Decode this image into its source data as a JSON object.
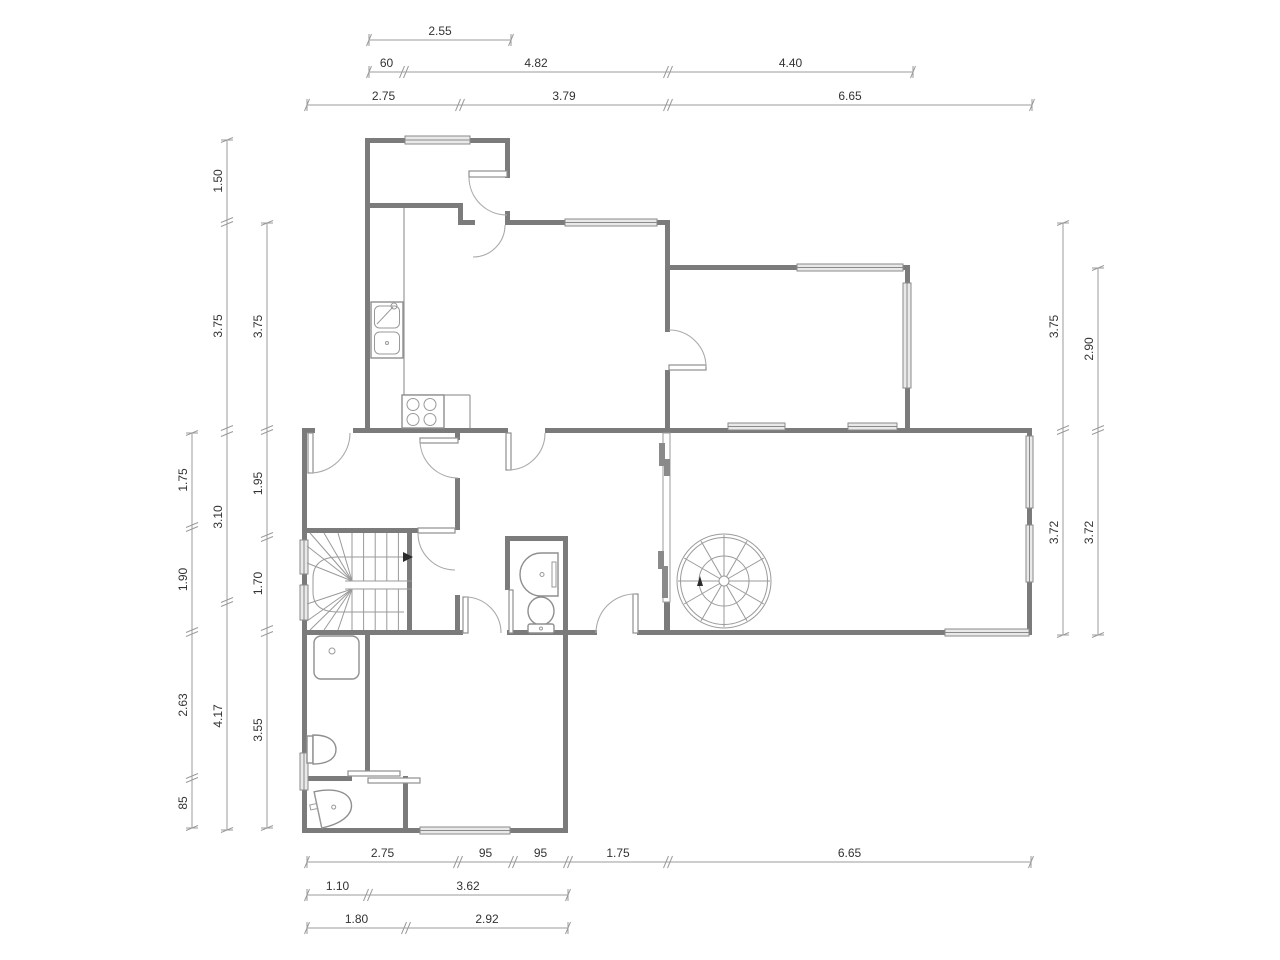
{
  "document": {
    "type": "architectural-floor-plan",
    "units": "meters-and-centimeters",
    "background": "#ffffff"
  },
  "colors": {
    "wall": "#7b7b7b",
    "dim_line": "#9b9b9b",
    "dim_text": "#333333",
    "fixture": "#8f8f8f"
  },
  "fixtures": [
    "kitchen-double-sink",
    "stove-4-burners",
    "spiral-staircase",
    "u-staircase",
    "shower",
    "toilet",
    "toilet",
    "washbasin",
    "washbasin",
    "sliding-door"
  ],
  "dimensions": {
    "text_size": 12,
    "lines": [
      {
        "o": "h",
        "p": 40,
        "s": [
          {
            "a": 369,
            "b": 511,
            "t": "2.55"
          }
        ]
      },
      {
        "o": "h",
        "p": 72,
        "s": [
          {
            "a": 369,
            "b": 404,
            "t": "60"
          },
          {
            "a": 404,
            "b": 668,
            "t": "4.82"
          },
          {
            "a": 668,
            "b": 913,
            "t": "4.40"
          }
        ]
      },
      {
        "o": "h",
        "p": 105,
        "s": [
          {
            "a": 307,
            "b": 460,
            "t": "2.75"
          },
          {
            "a": 460,
            "b": 668,
            "t": "3.79"
          },
          {
            "a": 668,
            "b": 1032,
            "t": "6.65"
          }
        ]
      },
      {
        "o": "v",
        "p": 227,
        "s": [
          {
            "a": 140,
            "b": 222,
            "t": "1.50"
          },
          {
            "a": 222,
            "b": 430,
            "t": "3.75"
          },
          {
            "a": 432,
            "b": 602,
            "t": "3.10"
          },
          {
            "a": 602,
            "b": 830,
            "t": "4.17"
          }
        ]
      },
      {
        "o": "v",
        "p": 192,
        "s": [
          {
            "a": 433,
            "b": 527,
            "t": "1.75"
          },
          {
            "a": 527,
            "b": 632,
            "t": "1.90"
          },
          {
            "a": 632,
            "b": 778,
            "t": "2.63"
          },
          {
            "a": 778,
            "b": 828,
            "t": "85"
          }
        ]
      },
      {
        "o": "v",
        "p": 267,
        "s": [
          {
            "a": 223,
            "b": 430,
            "t": "3.75"
          },
          {
            "a": 430,
            "b": 537,
            "t": "1.95"
          },
          {
            "a": 537,
            "b": 630,
            "t": "1.70"
          },
          {
            "a": 632,
            "b": 828,
            "t": "3.55"
          }
        ]
      },
      {
        "o": "v",
        "p": 1063,
        "s": [
          {
            "a": 223,
            "b": 430,
            "t": "3.75"
          },
          {
            "a": 430,
            "b": 635,
            "t": "3.72"
          }
        ]
      },
      {
        "o": "v",
        "p": 1098,
        "s": [
          {
            "a": 268,
            "b": 430,
            "t": "2.90"
          },
          {
            "a": 430,
            "b": 635,
            "t": "3.72"
          }
        ]
      },
      {
        "o": "h",
        "p": 862,
        "s": [
          {
            "a": 307,
            "b": 458,
            "t": "2.75"
          },
          {
            "a": 458,
            "b": 513,
            "t": "95"
          },
          {
            "a": 513,
            "b": 568,
            "t": "95"
          },
          {
            "a": 568,
            "b": 668,
            "t": "1.75"
          },
          {
            "a": 668,
            "b": 1031,
            "t": "6.65"
          }
        ]
      },
      {
        "o": "h",
        "p": 895,
        "s": [
          {
            "a": 307,
            "b": 368,
            "t": "1.10"
          },
          {
            "a": 368,
            "b": 568,
            "t": "3.62"
          }
        ]
      },
      {
        "o": "h",
        "p": 928,
        "s": [
          {
            "a": 307,
            "b": 406,
            "t": "1.80"
          },
          {
            "a": 406,
            "b": 568,
            "t": "2.92"
          }
        ]
      }
    ]
  }
}
